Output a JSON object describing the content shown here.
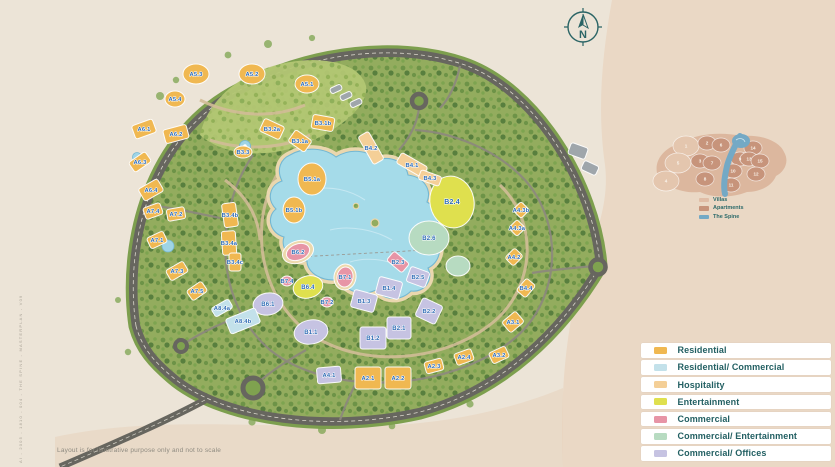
{
  "page": {
    "disclaimer": "Layout is for illustrative purpose only and not to scale",
    "side_code": "AI - 2005 - 1810 - 004 - THE SPINE - MASTERPLAN - V09"
  },
  "compass": {
    "label": "N"
  },
  "colors": {
    "R": "#f0b851",
    "RC": "#c3e1ea",
    "H": "#f4cf97",
    "E": "#dfe04e",
    "C": "#e795a6",
    "CE": "#b7dbc1",
    "CO": "#c6c3e2",
    "G": "#9fa6ab",
    "S": "#ecd9ad",
    "plot_label": "#2f6cb5"
  },
  "legend": {
    "items": [
      {
        "label": "Residential",
        "color": "#f0b851"
      },
      {
        "label": "Residential/ Commercial",
        "color": "#c3e1ea"
      },
      {
        "label": "Hospitality",
        "color": "#f4cf97"
      },
      {
        "label": "Entertainment",
        "color": "#dfe04e"
      },
      {
        "label": "Commercial",
        "color": "#e795a6"
      },
      {
        "label": "Commercial/ Entertainment",
        "color": "#b7dbc1"
      },
      {
        "label": "Commercial/ Offices",
        "color": "#c6c3e2"
      }
    ]
  },
  "inset": {
    "villas_color": "#e4c6ae",
    "apartments_color": "#c7947b",
    "spine_color": "#74a9c5",
    "legend": [
      {
        "label": "Villas",
        "color": "#e0bda6"
      },
      {
        "label": "Apartments",
        "color": "#c7947b"
      },
      {
        "label": "The Spine",
        "color": "#74a9c5"
      }
    ],
    "parcels": [
      {
        "n": "1",
        "t": "v",
        "x": 34,
        "y": 18
      },
      {
        "n": "2",
        "t": "a",
        "x": 55,
        "y": 15
      },
      {
        "n": "6",
        "t": "a",
        "x": 69,
        "y": 17
      },
      {
        "n": "14",
        "t": "a",
        "x": 101,
        "y": 20
      },
      {
        "n": "9",
        "t": "a",
        "x": 88,
        "y": 31
      },
      {
        "n": "13",
        "t": "a",
        "x": 97,
        "y": 31
      },
      {
        "n": "15",
        "t": "a",
        "x": 108,
        "y": 33
      },
      {
        "n": "5",
        "t": "v",
        "x": 26,
        "y": 35
      },
      {
        "n": "3",
        "t": "a",
        "x": 48,
        "y": 33
      },
      {
        "n": "7",
        "t": "a",
        "x": 60,
        "y": 35
      },
      {
        "n": "10",
        "t": "a",
        "x": 81,
        "y": 43
      },
      {
        "n": "12",
        "t": "a",
        "x": 104,
        "y": 46
      },
      {
        "n": "4",
        "t": "v",
        "x": 14,
        "y": 53
      },
      {
        "n": "8",
        "t": "a",
        "x": 53,
        "y": 51
      },
      {
        "n": "11",
        "t": "a",
        "x": 79,
        "y": 57
      }
    ]
  },
  "map": {
    "plots": [
      {
        "label": "",
        "cat": "S",
        "shape": "ellipse",
        "x": 298,
        "y": 252,
        "rx": 16,
        "ry": 11,
        "rot": -20
      },
      {
        "label": "",
        "cat": "S",
        "shape": "ellipse",
        "x": 345,
        "y": 277,
        "rx": 11,
        "ry": 13,
        "rot": 10
      },
      {
        "label": "B2.6",
        "cat": "CE",
        "shape": "ellipse",
        "x": 429,
        "y": 238,
        "rx": 20,
        "ry": 17,
        "rot": 0,
        "fs": 6
      },
      {
        "label": "",
        "cat": "CE",
        "shape": "ellipse",
        "x": 458,
        "y": 266,
        "rx": 12,
        "ry": 10,
        "rot": 0
      },
      {
        "label": "B2.4",
        "cat": "E",
        "shape": "ellipse",
        "x": 452,
        "y": 202,
        "rx": 22,
        "ry": 26,
        "rot": -12,
        "fs": 7
      },
      {
        "label": "B6.4",
        "cat": "E",
        "shape": "ellipse",
        "x": 308,
        "y": 287,
        "rx": 15,
        "ry": 11,
        "rot": -15,
        "fs": 6
      },
      {
        "label": "B4.2",
        "cat": "H",
        "shape": "rect",
        "x": 371,
        "y": 148,
        "rx": 6,
        "ry": 16,
        "rot": -30
      },
      {
        "label": "B4.1",
        "cat": "H",
        "shape": "rect",
        "x": 412,
        "y": 165,
        "rx": 6,
        "ry": 15,
        "rot": -60
      },
      {
        "label": "B4.3",
        "cat": "H",
        "shape": "rect",
        "x": 430,
        "y": 178,
        "rx": 5,
        "ry": 11,
        "rot": -70
      },
      {
        "label": "B5.1a",
        "cat": "R",
        "shape": "ellipse",
        "x": 312,
        "y": 179,
        "rx": 14,
        "ry": 16,
        "rot": 0
      },
      {
        "label": "B5.1b",
        "cat": "R",
        "shape": "ellipse",
        "x": 294,
        "y": 210,
        "rx": 11,
        "ry": 13,
        "rot": 0
      },
      {
        "label": "A5.3",
        "cat": "R",
        "shape": "ellipse",
        "x": 196,
        "y": 74,
        "rx": 13,
        "ry": 10,
        "rot": 0
      },
      {
        "label": "A5.2",
        "cat": "R",
        "shape": "ellipse",
        "x": 252,
        "y": 74,
        "rx": 13,
        "ry": 10,
        "rot": 0
      },
      {
        "label": "A5.1",
        "cat": "R",
        "shape": "ellipse",
        "x": 307,
        "y": 84,
        "rx": 12,
        "ry": 9,
        "rot": 0
      },
      {
        "label": "A5.4",
        "cat": "R",
        "shape": "ellipse",
        "x": 175,
        "y": 99,
        "rx": 10,
        "ry": 8,
        "rot": 0
      },
      {
        "label": "A6.1",
        "cat": "R",
        "shape": "rect",
        "x": 144,
        "y": 129,
        "rx": 11,
        "ry": 7,
        "rot": -20
      },
      {
        "label": "A6.2",
        "cat": "R",
        "shape": "rect",
        "x": 176,
        "y": 134,
        "rx": 12,
        "ry": 7,
        "rot": -15
      },
      {
        "label": "A6.3",
        "cat": "R",
        "shape": "rect",
        "x": 140,
        "y": 162,
        "rx": 10,
        "ry": 6,
        "rot": -35
      },
      {
        "label": "A6.4",
        "cat": "R",
        "shape": "rect",
        "x": 151,
        "y": 190,
        "rx": 11,
        "ry": 7,
        "rot": -30
      },
      {
        "label": "A7.4",
        "cat": "R",
        "shape": "rect",
        "x": 153,
        "y": 211,
        "rx": 9,
        "ry": 6,
        "rot": -20
      },
      {
        "label": "A7.2",
        "cat": "R",
        "shape": "rect",
        "x": 176,
        "y": 214,
        "rx": 9,
        "ry": 6,
        "rot": -10
      },
      {
        "label": "A7.1",
        "cat": "R",
        "shape": "rect",
        "x": 157,
        "y": 240,
        "rx": 9,
        "ry": 6,
        "rot": -25
      },
      {
        "label": "A7.3",
        "cat": "R",
        "shape": "rect",
        "x": 177,
        "y": 271,
        "rx": 10,
        "ry": 6,
        "rot": -30
      },
      {
        "label": "A7.5",
        "cat": "R",
        "shape": "rect",
        "x": 197,
        "y": 291,
        "rx": 9,
        "ry": 6,
        "rot": -35
      },
      {
        "label": "B3.2a",
        "cat": "R",
        "shape": "rect",
        "x": 272,
        "y": 129,
        "rx": 11,
        "ry": 7,
        "rot": 25
      },
      {
        "label": "B3.1b",
        "cat": "R",
        "shape": "rect",
        "x": 323,
        "y": 123,
        "rx": 11,
        "ry": 7,
        "rot": 10
      },
      {
        "label": "B3.1a",
        "cat": "R",
        "shape": "rect",
        "x": 300,
        "y": 141,
        "rx": 10,
        "ry": 7,
        "rot": 35
      },
      {
        "label": "B3.3",
        "cat": "R",
        "shape": "ellipse",
        "x": 243,
        "y": 152,
        "rx": 9,
        "ry": 6,
        "rot": 0
      },
      {
        "label": "B3.4b",
        "cat": "R",
        "shape": "rect",
        "x": 230,
        "y": 215,
        "rx": 7,
        "ry": 12,
        "rot": -8
      },
      {
        "label": "B3.4a",
        "cat": "R",
        "shape": "rect",
        "x": 229,
        "y": 243,
        "rx": 7,
        "ry": 12,
        "rot": -4
      },
      {
        "label": "B3.4c",
        "cat": "R",
        "shape": "rect",
        "x": 235,
        "y": 262,
        "rx": 6,
        "ry": 9,
        "rot": 0
      },
      {
        "label": "B6.2",
        "cat": "C",
        "shape": "ellipse",
        "x": 298,
        "y": 252,
        "rx": 12,
        "ry": 8,
        "rot": -20
      },
      {
        "label": "B7.1",
        "cat": "C",
        "shape": "ellipse",
        "x": 345,
        "y": 277,
        "rx": 8,
        "ry": 10,
        "rot": 10
      },
      {
        "label": "B7.2",
        "cat": "C",
        "shape": "ellipse",
        "x": 327,
        "y": 302,
        "rx": 6,
        "ry": 5,
        "rot": 0
      },
      {
        "label": "B7.4",
        "cat": "C",
        "shape": "ellipse",
        "x": 287,
        "y": 281,
        "rx": 6,
        "ry": 5,
        "rot": 0
      },
      {
        "label": "B2.3",
        "cat": "C",
        "shape": "rect",
        "x": 398,
        "y": 262,
        "rx": 10,
        "ry": 6,
        "rot": 40
      },
      {
        "label": "B6.1",
        "cat": "CO",
        "shape": "ellipse",
        "x": 268,
        "y": 304,
        "rx": 15,
        "ry": 11,
        "rot": -10,
        "fs": 6
      },
      {
        "label": "B1.1",
        "cat": "CO",
        "shape": "ellipse",
        "x": 311,
        "y": 332,
        "rx": 17,
        "ry": 12,
        "rot": -10,
        "fs": 6
      },
      {
        "label": "B1.3",
        "cat": "CO",
        "shape": "rect",
        "x": 364,
        "y": 301,
        "rx": 12,
        "ry": 9,
        "rot": 15
      },
      {
        "label": "B1.4",
        "cat": "CO",
        "shape": "rect",
        "x": 389,
        "y": 288,
        "rx": 12,
        "ry": 9,
        "rot": 15
      },
      {
        "label": "B1.2",
        "cat": "CO",
        "shape": "rect",
        "x": 373,
        "y": 338,
        "rx": 13,
        "ry": 11,
        "rot": 0,
        "fs": 6
      },
      {
        "label": "B2.1",
        "cat": "CO",
        "shape": "rect",
        "x": 399,
        "y": 328,
        "rx": 12,
        "ry": 11,
        "rot": 0,
        "fs": 6
      },
      {
        "label": "B2.2",
        "cat": "CO",
        "shape": "rect",
        "x": 429,
        "y": 311,
        "rx": 11,
        "ry": 10,
        "rot": 25
      },
      {
        "label": "B2.5",
        "cat": "CO",
        "shape": "rect",
        "x": 418,
        "y": 277,
        "rx": 10,
        "ry": 8,
        "rot": 20
      },
      {
        "label": "A4.1",
        "cat": "CO",
        "shape": "rect",
        "x": 329,
        "y": 375,
        "rx": 12,
        "ry": 8,
        "rot": -5
      },
      {
        "label": "A8.4a",
        "cat": "RC",
        "shape": "rect",
        "x": 222,
        "y": 308,
        "rx": 10,
        "ry": 5,
        "rot": -30
      },
      {
        "label": "A8.4b",
        "cat": "RC",
        "shape": "rect",
        "x": 243,
        "y": 321,
        "rx": 16,
        "ry": 8,
        "rot": -22
      },
      {
        "label": "A2.1",
        "cat": "R",
        "shape": "rect",
        "x": 368,
        "y": 378,
        "rx": 13,
        "ry": 11,
        "rot": 0
      },
      {
        "label": "A2.2",
        "cat": "R",
        "shape": "rect",
        "x": 398,
        "y": 378,
        "rx": 13,
        "ry": 11,
        "rot": 0
      },
      {
        "label": "A2.3",
        "cat": "R",
        "shape": "rect",
        "x": 434,
        "y": 366,
        "rx": 9,
        "ry": 6,
        "rot": -15
      },
      {
        "label": "A2.4",
        "cat": "R",
        "shape": "rect",
        "x": 464,
        "y": 357,
        "rx": 9,
        "ry": 6,
        "rot": -20
      },
      {
        "label": "A3.1",
        "cat": "R",
        "shape": "rect",
        "x": 513,
        "y": 322,
        "rx": 9,
        "ry": 7,
        "rot": -40
      },
      {
        "label": "A3.2",
        "cat": "R",
        "shape": "rect",
        "x": 499,
        "y": 355,
        "rx": 9,
        "ry": 6,
        "rot": -25
      },
      {
        "label": "B4.4",
        "cat": "R",
        "shape": "rect",
        "x": 526,
        "y": 288,
        "rx": 8,
        "ry": 6,
        "rot": -50
      },
      {
        "label": "A4.2",
        "cat": "R",
        "shape": "rect",
        "x": 514,
        "y": 257,
        "rx": 7,
        "ry": 6,
        "rot": -45
      },
      {
        "label": "A4.3a",
        "cat": "R",
        "shape": "rect",
        "x": 517,
        "y": 228,
        "rx": 6,
        "ry": 6,
        "rot": 45
      },
      {
        "label": "A4.3b",
        "cat": "R",
        "shape": "rect",
        "x": 521,
        "y": 210,
        "rx": 6,
        "ry": 6,
        "rot": 45
      },
      {
        "label": "",
        "cat": "G",
        "shape": "rect",
        "x": 336,
        "y": 89,
        "rx": 6,
        "ry": 3,
        "rot": -25
      },
      {
        "label": "",
        "cat": "G",
        "shape": "rect",
        "x": 346,
        "y": 96,
        "rx": 6,
        "ry": 3,
        "rot": -25
      },
      {
        "label": "",
        "cat": "G",
        "shape": "rect",
        "x": 356,
        "y": 103,
        "rx": 6,
        "ry": 3,
        "rot": -25
      },
      {
        "label": "",
        "cat": "G",
        "shape": "rect",
        "x": 578,
        "y": 151,
        "rx": 9,
        "ry": 6,
        "rot": 20
      },
      {
        "label": "",
        "cat": "G",
        "shape": "rect",
        "x": 590,
        "y": 168,
        "rx": 8,
        "ry": 5,
        "rot": 25
      }
    ]
  }
}
